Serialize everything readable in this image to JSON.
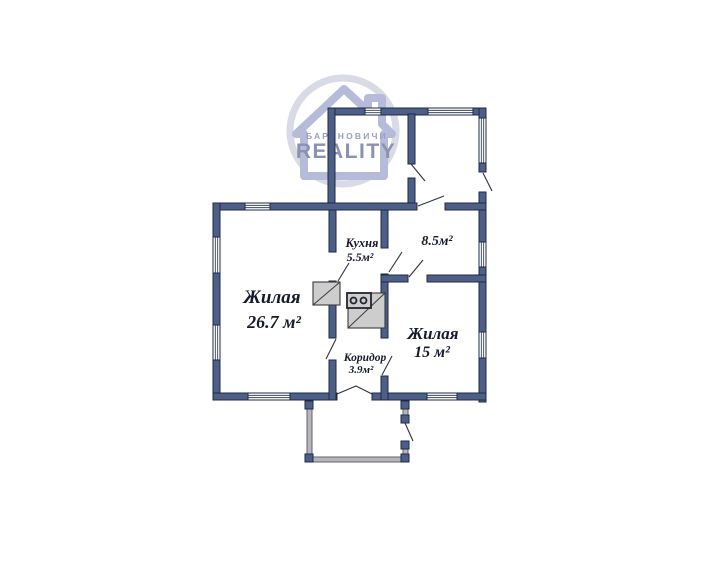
{
  "watermark": {
    "city": "БАРАНОВИЧИ",
    "brand": "REALITY"
  },
  "rooms": [
    {
      "name": "Жилая",
      "area": "26.7 м²"
    },
    {
      "name": "Кухня",
      "area": "5.5м²"
    },
    {
      "name": "",
      "area": "8.5м²"
    },
    {
      "name": "Жилая",
      "area": "15 м²"
    },
    {
      "name": "Коридор",
      "area": "3.9м²"
    }
  ],
  "colors": {
    "background": "#ffffff",
    "wall_fill": "#4d5f86",
    "wall_outline": "#1f2945",
    "porch_wall": "#b6b6ba",
    "window_fill": "#ffffff",
    "stove_fill": "#cdcdcd",
    "label_text": "#151a2c",
    "logo_text": "#8b91b0",
    "logo_house_outline": "#b6bbd9",
    "logo_circle": "#d8dae6"
  }
}
